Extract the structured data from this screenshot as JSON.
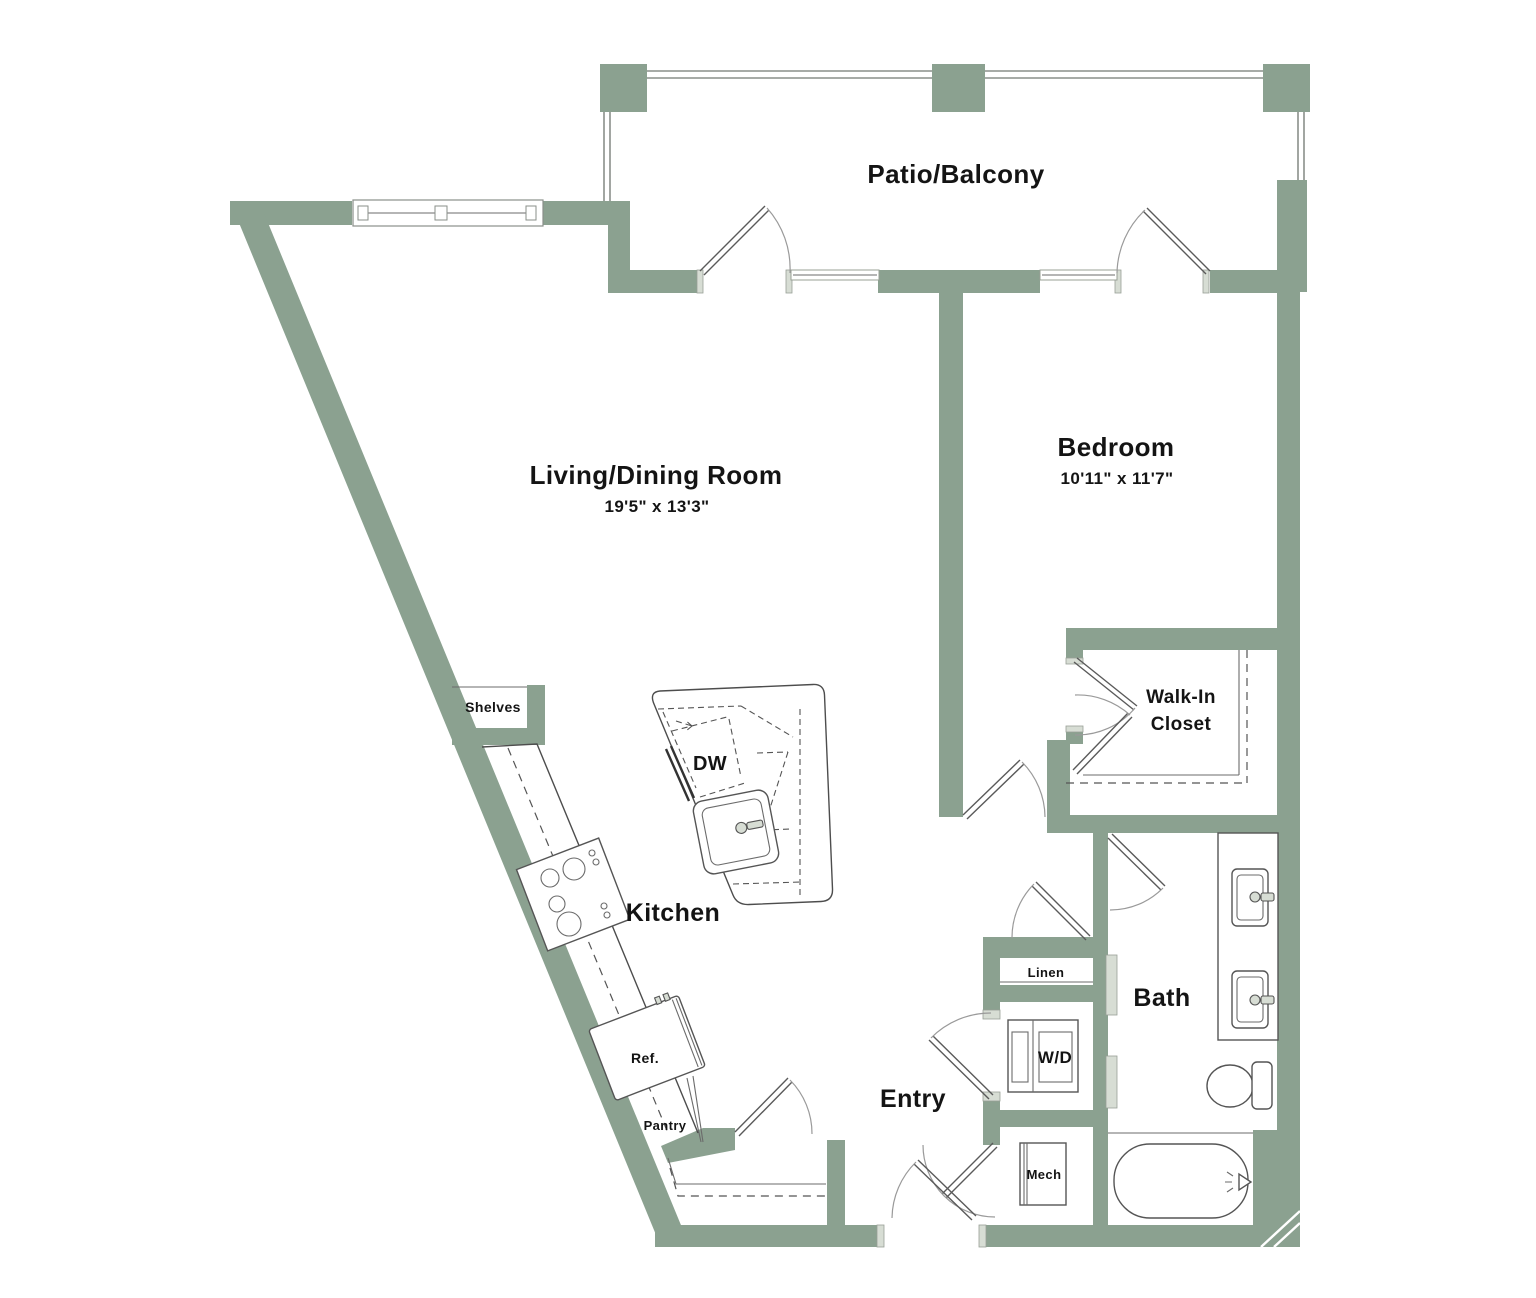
{
  "palette": {
    "wall": "#8BA190",
    "fixture_light": "#D7DDD4",
    "line": "#4d4d4d",
    "door_arc": "#9a9a9a",
    "text": "#141414",
    "background": "#ffffff"
  },
  "rooms": {
    "patio": {
      "label": "Patio/Balcony"
    },
    "living": {
      "label": "Living/Dining Room",
      "dims": "19'5\" x 13'3\""
    },
    "bedroom": {
      "label": "Bedroom",
      "dims": "10'11\" x 11'7\""
    },
    "walk_in_closet": {
      "label_line1": "Walk-In",
      "label_line2": "Closet"
    },
    "kitchen": {
      "label": "Kitchen"
    },
    "entry": {
      "label": "Entry"
    },
    "bath": {
      "label": "Bath"
    }
  },
  "features": {
    "shelves": {
      "label": "Shelves"
    },
    "dishwasher": {
      "label": "DW"
    },
    "refrigerator": {
      "label": "Ref."
    },
    "pantry": {
      "label": "Pantry"
    },
    "linen": {
      "label": "Linen"
    },
    "washer_dryer": {
      "label": "W/D"
    },
    "mechanical": {
      "label": "Mech"
    }
  }
}
